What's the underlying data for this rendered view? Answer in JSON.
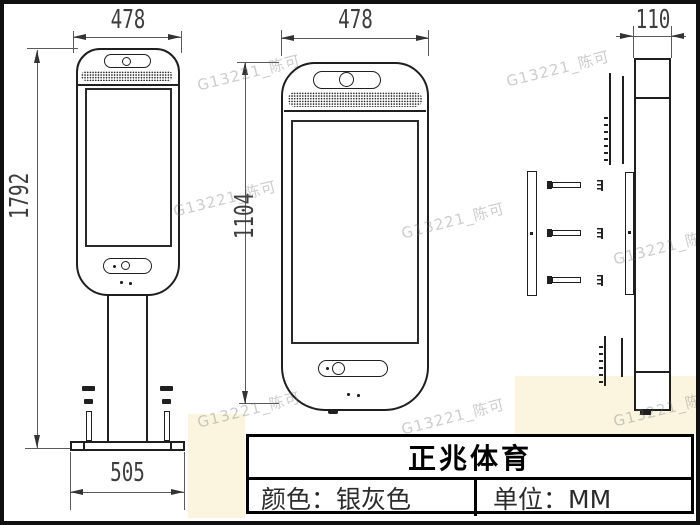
{
  "dimensions": {
    "front_stand": {
      "width": "478",
      "height": "1792",
      "base_width": "505"
    },
    "front_unit": {
      "width": "478",
      "height": "1104"
    },
    "side": {
      "depth": "110"
    }
  },
  "title_block": {
    "company": "正兆体育",
    "color_label": "颜色：银灰色",
    "unit_label": "单位：MM"
  },
  "watermark": {
    "text": "G13221_陈可"
  }
}
